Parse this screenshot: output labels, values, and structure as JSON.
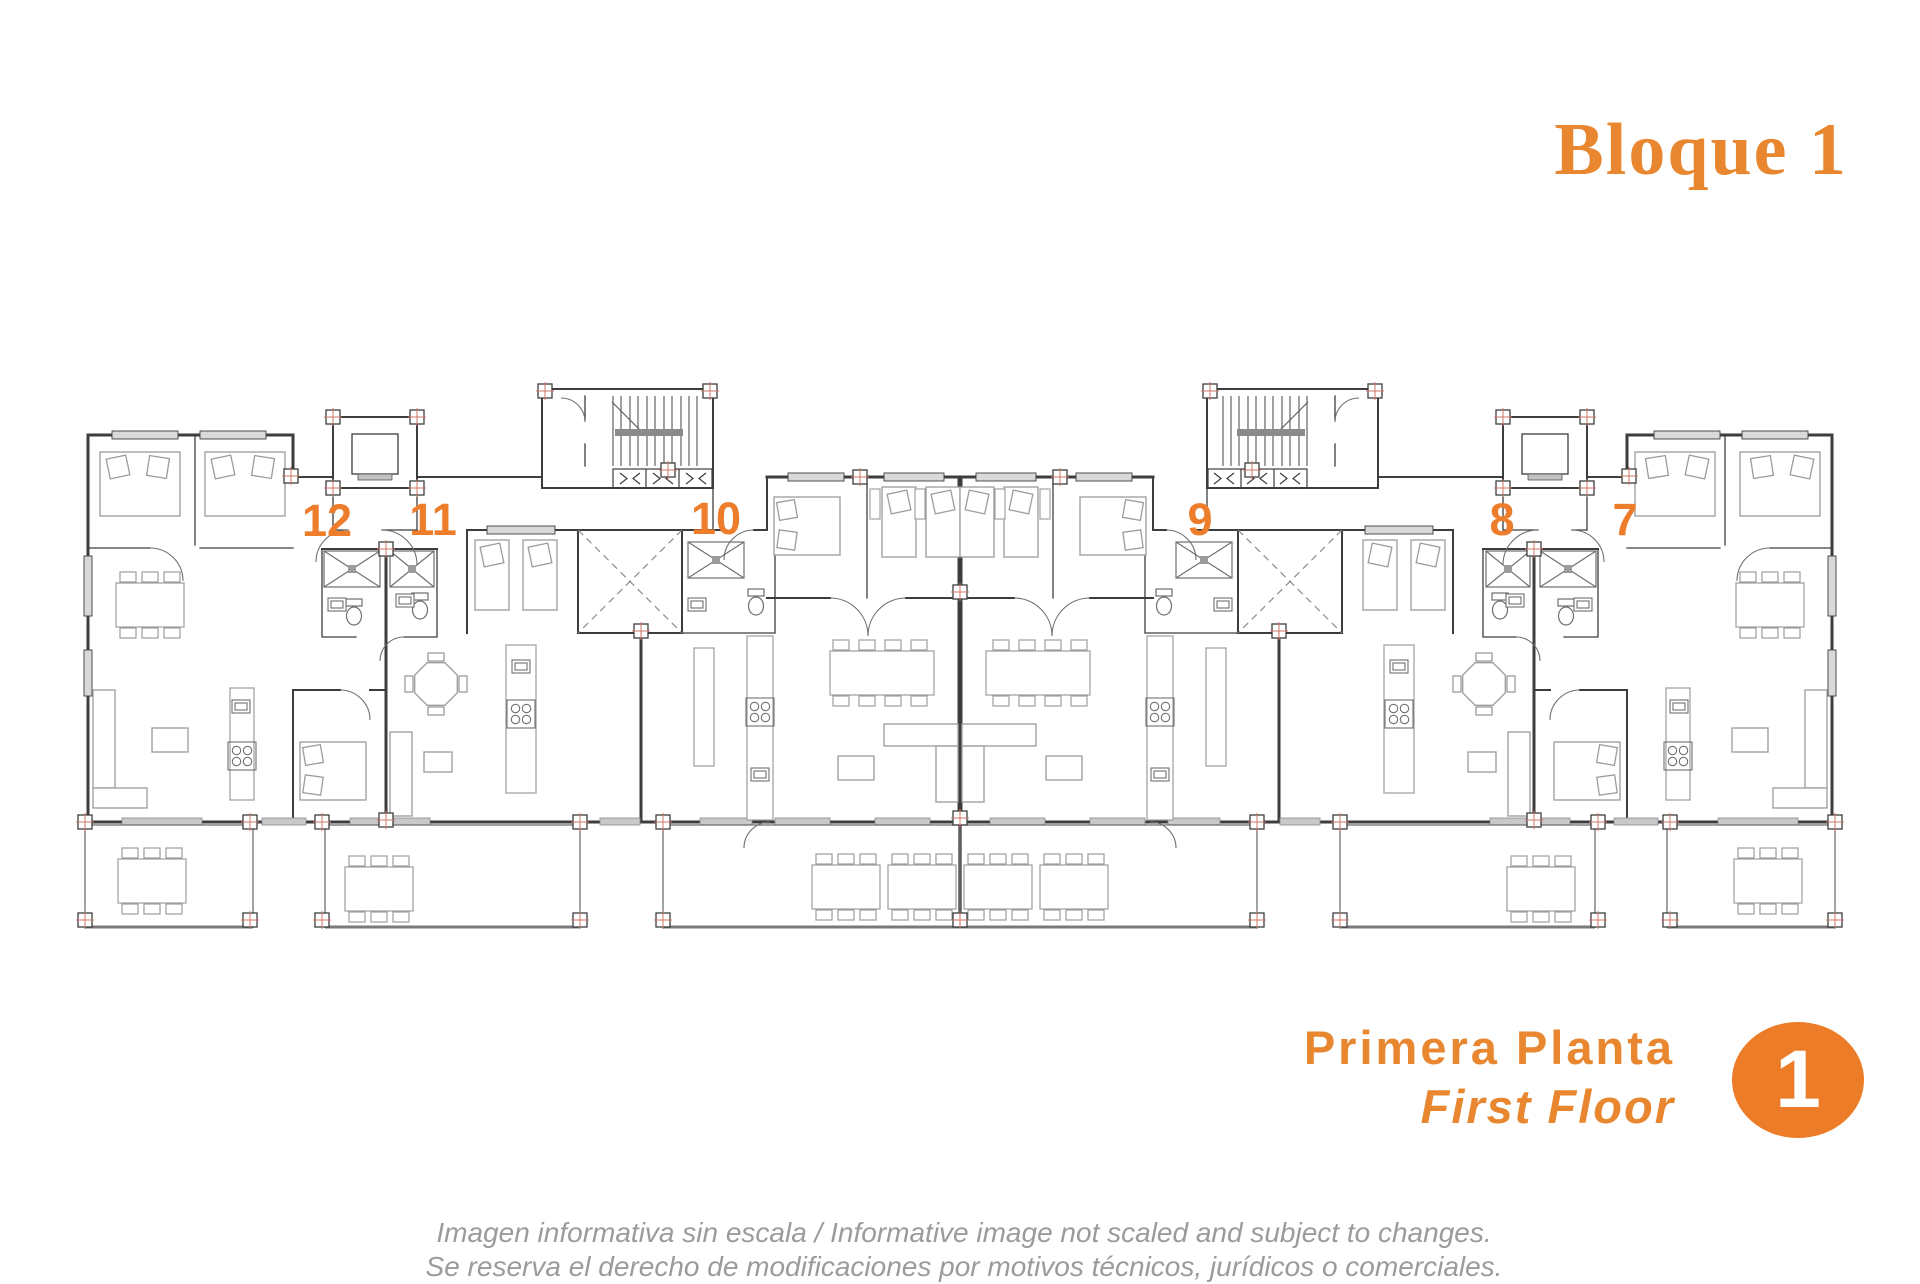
{
  "title": "Bloque 1",
  "units": [
    {
      "label": "12"
    },
    {
      "label": "11"
    },
    {
      "label": "10"
    },
    {
      "label": "9"
    },
    {
      "label": "8"
    },
    {
      "label": "7"
    }
  ],
  "floor": {
    "title_es": "Primera Planta",
    "title_en": "First Floor",
    "badge": "1"
  },
  "disclaimer": {
    "line1": "Imagen informativa sin escala /  Informative image not scaled and subject to changes.",
    "line2": "Se reserva el derecho de modificaciones por motivos técnicos, jurídicos o comerciales."
  },
  "colors": {
    "accent_title": "#E8872F",
    "accent_labels": "#ED7C2B",
    "badge_fill": "#EC7C27",
    "badge_text": "#FFFFFF",
    "walls": "#3D3D3D",
    "furniture": "#9C9C9C",
    "window_fill": "#D9D9D9",
    "column_marker_cross": "#D2756A",
    "disclaimer_text": "#9B9B9E"
  },
  "plan_features": [
    "stair-core",
    "elevator-core",
    "light-well",
    "terrace",
    "apartment-units"
  ]
}
